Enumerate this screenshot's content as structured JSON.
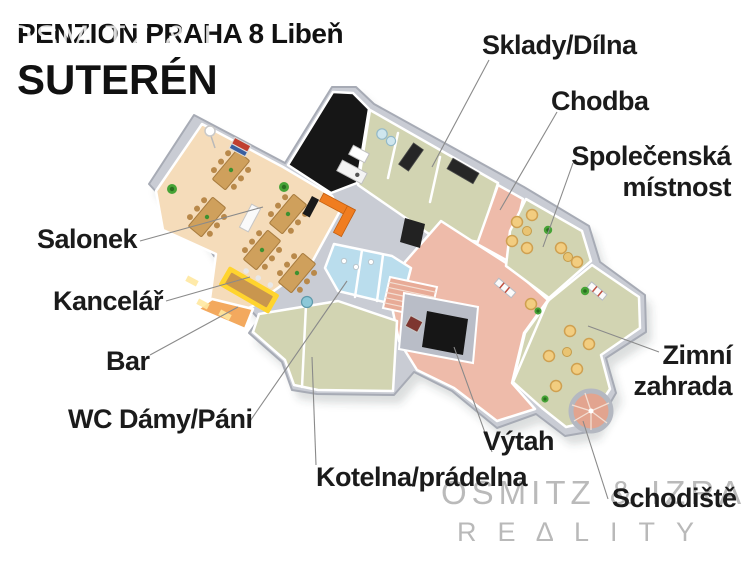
{
  "header": {
    "title": "PENZION PRAHA 8 Libeň",
    "subtitle": "SUTERÉN"
  },
  "labels": {
    "sklady": "Sklady/Dílna",
    "chodba": "Chodba",
    "spolecenska": "Společenská místnost",
    "salonek": "Salonek",
    "kancelar": "Kancelář",
    "bar": "Bar",
    "wc": "WC Dámy/Páni",
    "zimni": "Zimní zahrada",
    "vytah": "Výtah",
    "kotelna": "Kotelna/prádelna",
    "schodiste": "Schodiště"
  },
  "watermark": {
    "brand": "OSMITZ & IZRA",
    "tagline": "RE∆LITY"
  },
  "palette": {
    "wall": "#c9ccd4",
    "wall_edge": "#a7abb5",
    "floor_tan": "#f5dcba",
    "floor_sage": "#d2d4b2",
    "floor_salmon": "#eebbaa",
    "floor_blue": "#badded",
    "floor_office": "#f3a95e",
    "floor_dark": "#161616",
    "counter_orange": "#f07d20",
    "bar_yellow": "#ffd42e",
    "wood": "#cfa05c",
    "armchair": "#f2cd80",
    "plant_green": "#3d9130",
    "leader_line": "#8a8a8a",
    "text": "#1b1b1b",
    "watermark_gray": "#aeaeae"
  }
}
